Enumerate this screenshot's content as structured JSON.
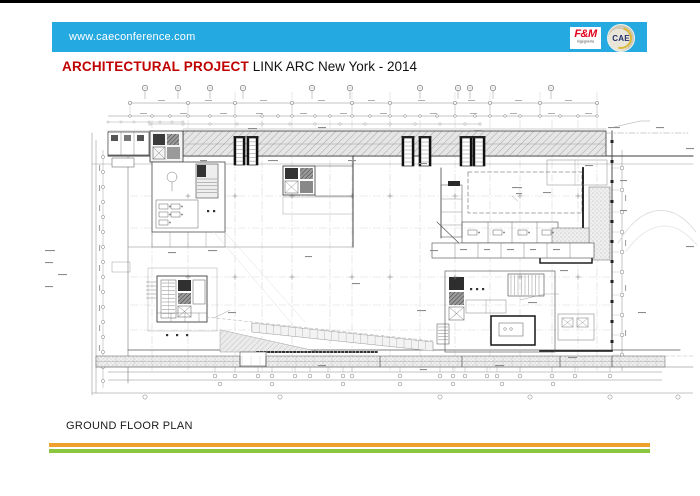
{
  "header": {
    "website": "www.caeconference.com",
    "fm_logo": {
      "name": "F&M",
      "subtitle": "ingegneria"
    },
    "cae_logo": {
      "name": "CAE"
    }
  },
  "title": {
    "primary": "ARCHITECTURAL PROJECT",
    "secondary": " LINK ARC New York - 2014"
  },
  "footer": {
    "caption": "GROUND FLOOR PLAN"
  },
  "colors": {
    "banner_blue": "#24A9E1",
    "title_red": "#C00000",
    "fm_red": "#E2001A",
    "stripe_orange": "#F0A02C",
    "stripe_green": "#8CC63F"
  }
}
